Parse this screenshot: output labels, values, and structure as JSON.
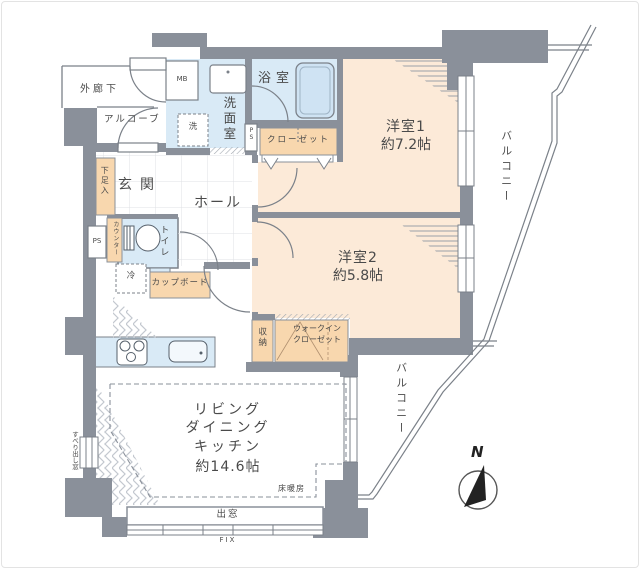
{
  "plan": {
    "rooms": {
      "bedroom1": {
        "name": "洋室1",
        "size": "約7.2帖"
      },
      "bedroom2": {
        "name": "洋室2",
        "size": "約5.8帖"
      },
      "ldk": {
        "line1": "リビング",
        "line2": "ダイニング",
        "line3": "キッチン",
        "size": "約14.6帖"
      },
      "bath": "浴室",
      "washroom": "洗面室",
      "toilet": "トイレ",
      "entrance": "玄関",
      "hall": "ホール"
    },
    "storage": {
      "closet": "クローゼット",
      "walkin_line1": "ウォークイン",
      "walkin_line2": "クローゼット",
      "shunou": "収納",
      "shoe_box": "下足入",
      "cupboard": "カップボード",
      "counter": "カウンター"
    },
    "fixtures": {
      "meter_box": "MB",
      "pipe_space_left": "PS",
      "pipe_space_right": "PS",
      "washer": "洗",
      "fridge": "冷"
    },
    "annotations": {
      "corridor": "外廊下",
      "alcove": "アルコーブ",
      "balcony_right": "バルコニー",
      "balcony_bottom": "バルコニー",
      "floor_heating": "床暖房",
      "bay_window": "出窓",
      "fix_window": "FIX",
      "casement_window": "すべり出し窓",
      "north": "N"
    },
    "colors": {
      "wall": "#8a909a",
      "bedroom_fill": "#fcead8",
      "wet_area_fill": "#d9eaf6",
      "storage_fill": "#f8d7ae",
      "bathtub_fill": "#cfe3f3",
      "line": "#7b8189",
      "label_text": "#4a4a4a"
    }
  }
}
